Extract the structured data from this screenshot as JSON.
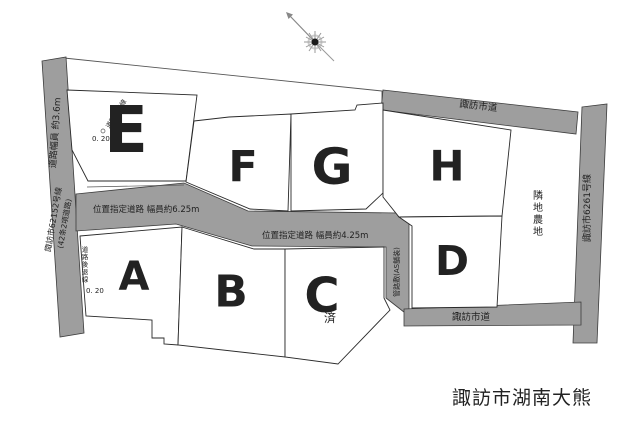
{
  "map": {
    "watermark": "諏訪市湖南大熊",
    "colors": {
      "road_gray": "#9e9e9e",
      "plot_red": "#e8211c",
      "sold_gray": "#c9c9c9",
      "watermark_gray": "#c8c8c8"
    },
    "roads": {
      "left_width": "道路幅員 約3.6m",
      "left_name": "諏訪市62152号線",
      "left_name_sub": "(42条2項道路)",
      "top": "諏訪市道",
      "right_name": "諏訪市6261号線",
      "middle_upper": "位置指定道路 幅員約6.25m",
      "middle_lower": "位置指定道路 幅員約4.25m",
      "bottom": "諏訪市道",
      "conduit": "管路敷(AS舗装)"
    },
    "annotations": {
      "setback_upper": "道路後退線",
      "setback_upper_offset": "0. 20",
      "setback_lower": "道路後退線",
      "setback_lower_offset": "0. 20",
      "adjacent_farmland": "隣地農地",
      "sold": "済"
    },
    "plots": {
      "a": "A",
      "b": "B",
      "c": "C",
      "d": "D",
      "e": "E",
      "f": "F",
      "g": "G",
      "h": "H"
    }
  }
}
